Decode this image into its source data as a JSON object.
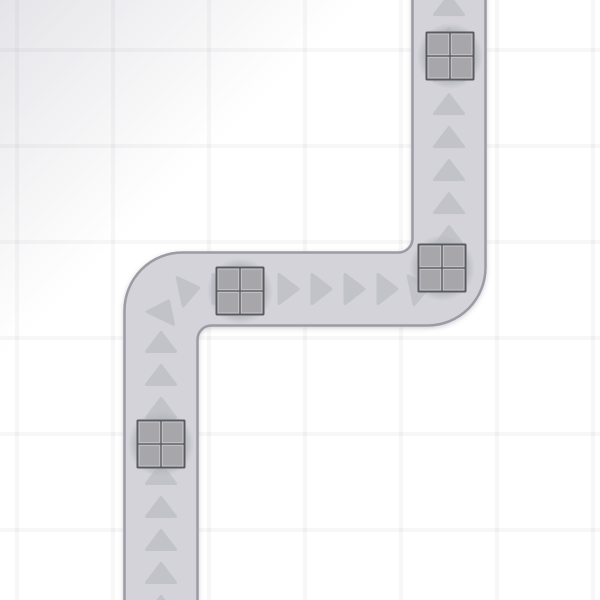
{
  "scene": {
    "canvas": {
      "width": 600,
      "height": 600
    },
    "background": {
      "base_color": "#ffffff",
      "grid_cell_size": 96,
      "grid_line_width": 4,
      "grid_line_color": "rgba(105,105,130,0.055)",
      "grid_offset_x": 15,
      "grid_offset_y": 48,
      "corner_shade_color_rgb": "124,124,142",
      "corner_shade_opacity": 0.2,
      "corner_shade_extent_pct": 30
    },
    "road": {
      "fill": "#d3d3d9",
      "border_color": "#9b9ba3",
      "border_width": 2.5,
      "width": 73,
      "outer_corner_radius": 58,
      "inner_corner_radius": 14,
      "centerline_corner_radius": 36,
      "centerline": [
        {
          "x": 161,
          "y": 640
        },
        {
          "x": 161,
          "y": 289
        },
        {
          "x": 449,
          "y": 289
        },
        {
          "x": 449,
          "y": -40
        }
      ],
      "shadow": {
        "dx": 0,
        "dy": 1.5,
        "blur": 2.5,
        "color": "#5a5a70",
        "opacity": 0.28
      }
    },
    "flow_arrows": {
      "color": "#c2c2c9",
      "spacing": 33,
      "start_offset": 34,
      "width": 29,
      "height": 19,
      "corner_round": 3
    },
    "pads": {
      "color": "#b7b7bf",
      "radius": 33,
      "opacity": 0.8
    },
    "crates": [
      {
        "id": "crate-1",
        "x": 450,
        "y": 56
      },
      {
        "id": "crate-2",
        "x": 442,
        "y": 268
      },
      {
        "id": "crate-3",
        "x": 240,
        "y": 291
      },
      {
        "id": "crate-4",
        "x": 161,
        "y": 444
      }
    ],
    "crate_style": {
      "size": 49,
      "frame_color": "#595960",
      "frame_thickness": 2.5,
      "cross_thickness": 2.5,
      "cell_fill": "#a6a6ab",
      "cell_edge_color": "#c6c6cb",
      "cell_edge_width": 1.1,
      "corner_radius": 1.5
    }
  }
}
